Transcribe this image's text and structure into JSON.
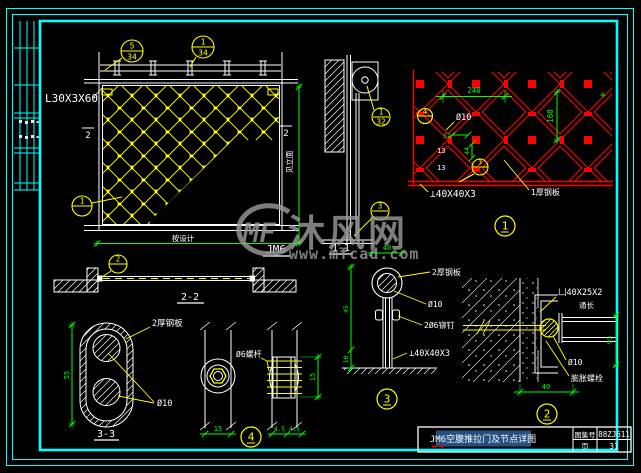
{
  "watermark": {
    "logo": "MF",
    "brand": "沐风网",
    "url": "www.mfcad.com"
  },
  "title_block": {
    "title": "JM6空腹推拉门及节点详图",
    "atlas_label": "图集号",
    "atlas_no": "88ZJ611",
    "page_label": "页",
    "page_no": "31"
  },
  "elevation": {
    "name": "JM6",
    "angle": "L30X3X60",
    "dim_w": "按设计",
    "dim_h": "见立面",
    "sec_l": "2",
    "sec_r": "2",
    "c1n": "5",
    "c1p": "34",
    "c2n": "1",
    "c2p": "34",
    "c3n": "1"
  },
  "sec11": {
    "title": "1-1",
    "c1n": "1",
    "c1p": "32",
    "c2n": "3"
  },
  "det1": {
    "no": "1",
    "d240": "240",
    "d160": "160",
    "d52": "52",
    "d44": "44",
    "d13a": "13",
    "d13b": "13",
    "phi": "Ø10",
    "angle": "⊥40X40X3",
    "plate": "1厚钢板",
    "c4": "4",
    "c3": "3"
  },
  "sec22": {
    "title": "2-2",
    "c": "2"
  },
  "sec33": {
    "title": "3-3",
    "d55": "55",
    "plate": "2厚钢板",
    "phi": "Ø10"
  },
  "det4": {
    "no": "4",
    "rod": "Ø6螺杆",
    "d15a": "15",
    "d15b": "15",
    "d45a": "4.5",
    "d45b": "4.5"
  },
  "det3": {
    "no": "3",
    "d40": "40",
    "d45": "45",
    "d10": "10",
    "plate": "2厚钢板",
    "phi": "Ø10",
    "rivet": "2Ø6铆钉",
    "angle": "⊥40X40X3"
  },
  "det2": {
    "no": "2",
    "channel": "凵40X25X2",
    "note": "通长",
    "phi": "Ø10",
    "anchor": "膨胀螺栓",
    "d40": "40",
    "d93": "93"
  }
}
